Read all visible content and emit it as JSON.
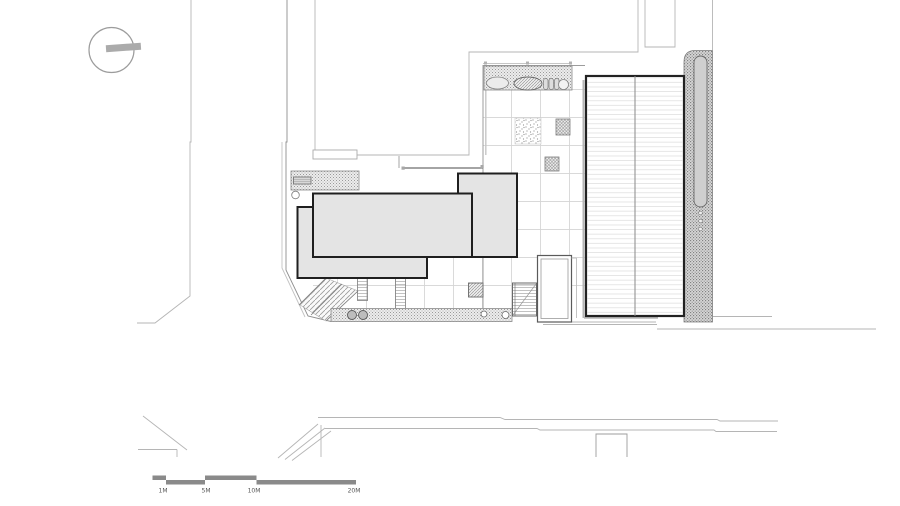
{
  "drawing": {
    "kind": "architectural-site-plan",
    "scale_bar": {
      "labels": [
        "1M",
        "5M",
        "10M",
        "20M"
      ]
    },
    "colors": {
      "background": "#ffffff",
      "building_fill": "#e4e4e4",
      "building_outline": "#1f1f1f",
      "property_line": "#b5b5b5",
      "site_edge": "#8f8f8f",
      "grid_line": "#d4d4d4",
      "hatch": "#9a9a9a",
      "scale_bar": "#8a8a8a"
    }
  }
}
